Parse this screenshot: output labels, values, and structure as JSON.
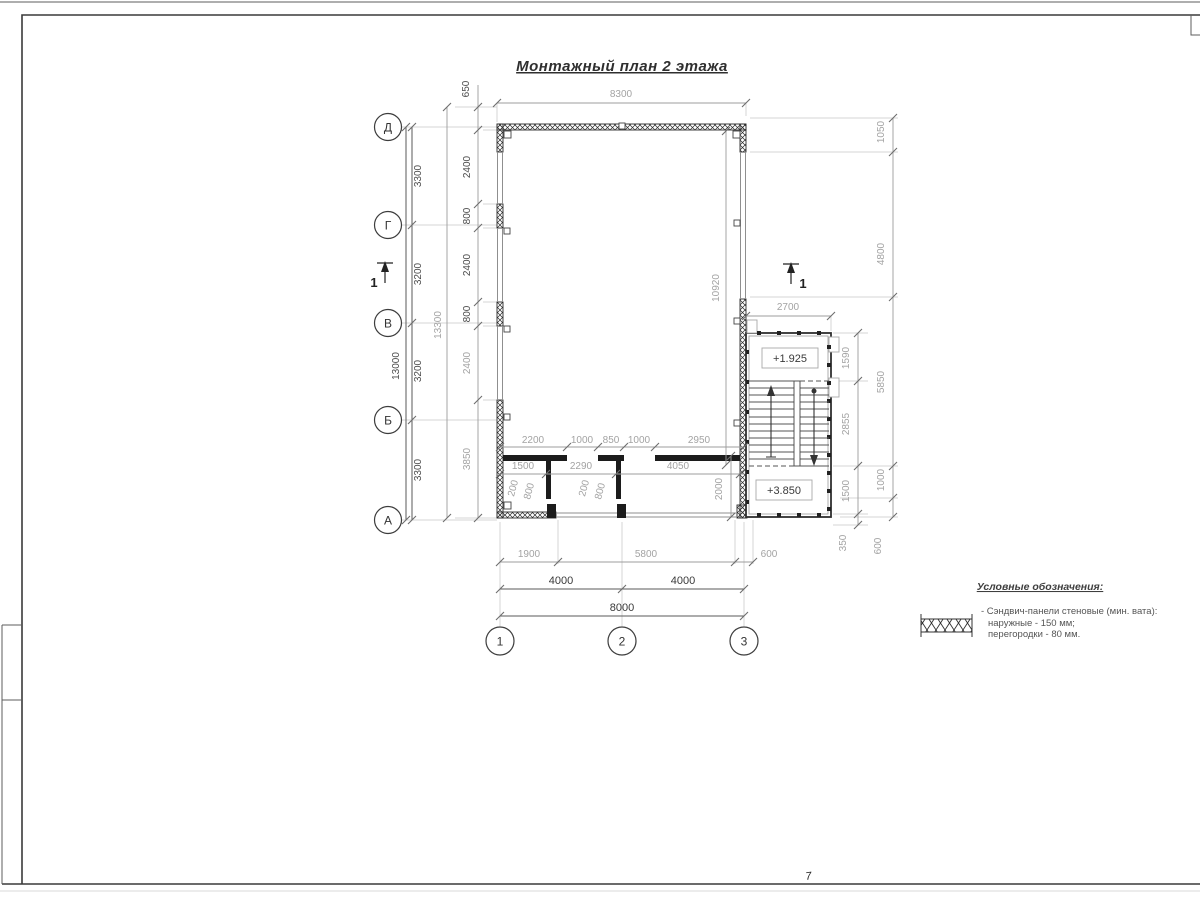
{
  "title": {
    "text": "Монтажный план 2 этажа"
  },
  "axes": {
    "rows": [
      "Д",
      "Г",
      "В",
      "Б",
      "А"
    ],
    "cols": [
      "1",
      "2",
      "3"
    ]
  },
  "section": {
    "label": "1"
  },
  "elevations": {
    "mid_landing": "+1.925",
    "floor": "+3.850"
  },
  "dims": {
    "top_width": "8300",
    "top_offset": "650",
    "left_overall": "13000",
    "left_spans": [
      "3300",
      "3200",
      "3200",
      "3300"
    ],
    "left_total": "13300",
    "left_wall": [
      "2400",
      "800",
      "2400",
      "800",
      "2400",
      "3850"
    ],
    "east_wall_len": "10920",
    "stair_width": "2700",
    "right_inner": [
      "1590",
      "2855",
      "1500",
      "350"
    ],
    "right_outer": [
      "1050",
      "4800",
      "5850",
      "1000",
      "600"
    ],
    "partition_row": [
      "2200",
      "1000",
      "850",
      "1000",
      "2950"
    ],
    "room_row": [
      "1500",
      "2290",
      "4050"
    ],
    "small_dims": [
      "200",
      "800",
      "200",
      "800"
    ],
    "room_depth": "2000",
    "bottom_spans": [
      "1900",
      "5800",
      "600"
    ],
    "bottom_axis": [
      "4000",
      "4000"
    ],
    "bottom_overall": "8000"
  },
  "legend": {
    "title": "Условные обозначения:",
    "symbol": "sandwich-panel-hatch",
    "item_lines": [
      "- Сэндвич-панели стеновые (мин. вата):",
      "наружные - 150 мм;",
      "перегородки - 80 мм."
    ]
  },
  "sheet": {
    "page_mark": "7"
  }
}
